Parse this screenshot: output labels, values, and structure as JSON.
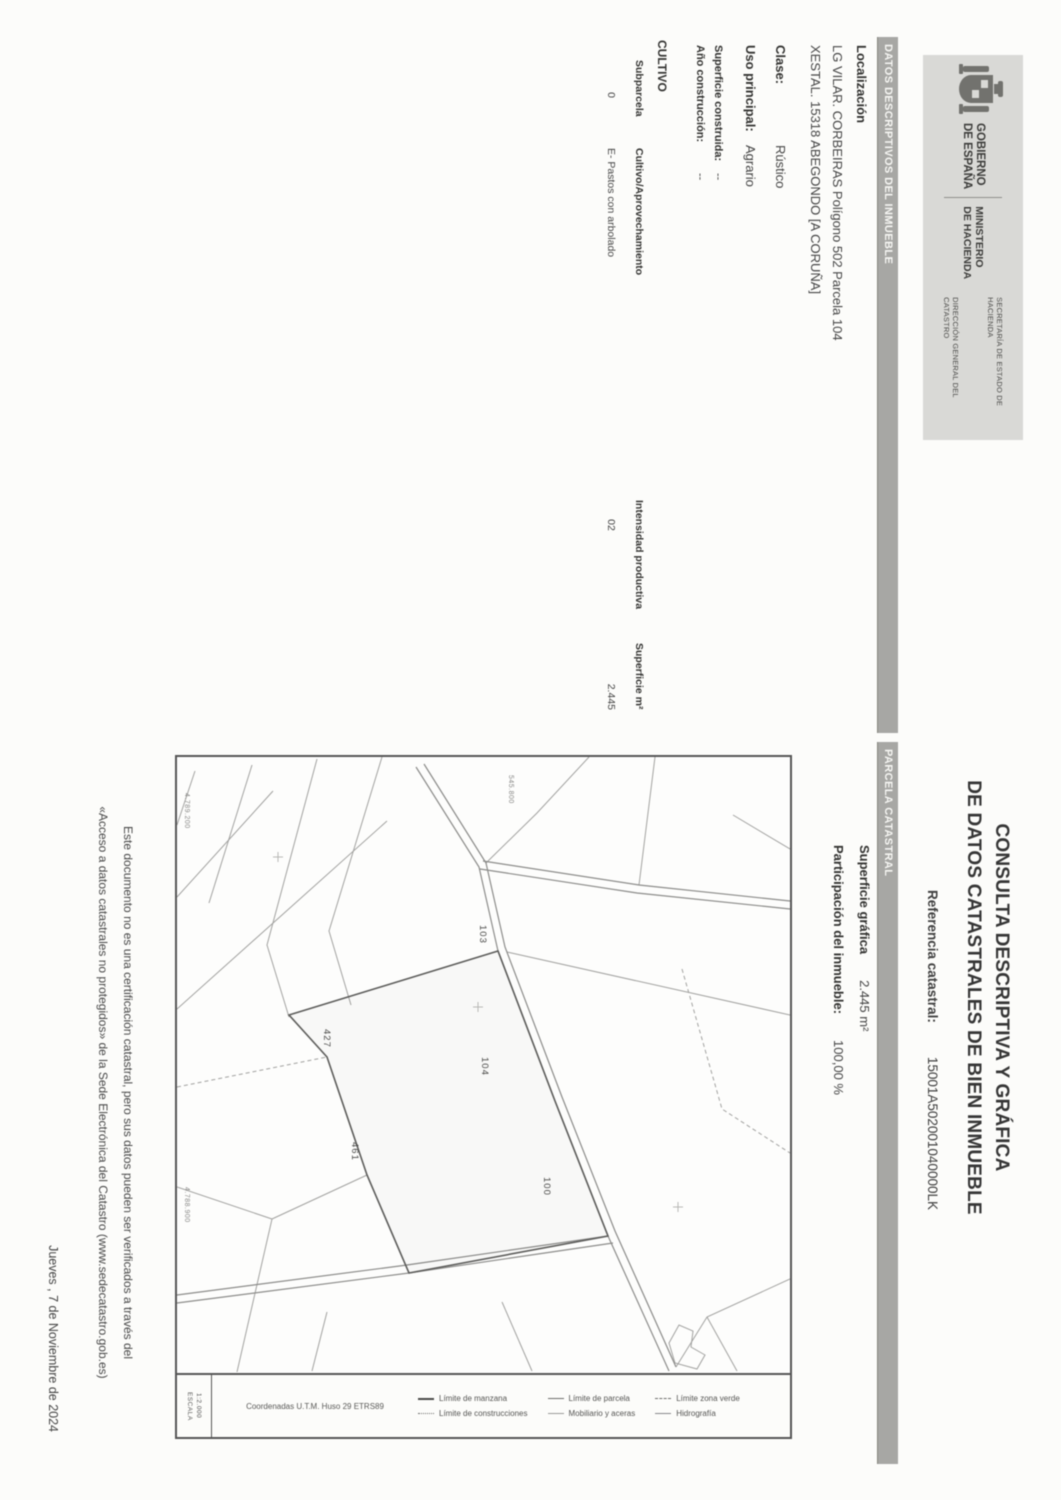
{
  "header": {
    "government": {
      "line1": "GOBIERNO",
      "line2": "DE ESPAÑA",
      "ministry1": "MINISTERIO",
      "ministry2": "DE HACIENDA",
      "secretaria": "SECRETARÍA DE ESTADO DE HACIENDA",
      "direccion": "DIRECCIÓN GENERAL DEL CATASTRO"
    },
    "title_line1": "CONSULTA DESCRIPTIVA Y GRÁFICA",
    "title_line2": "DE DATOS CATASTRALES DE BIEN INMUEBLE",
    "ref_label": "Referencia catastral:",
    "ref_value": "15001A502001040000LK"
  },
  "sections": {
    "inmueble_bar": "DATOS DESCRIPTIVOS DEL INMUEBLE",
    "parcela_bar": "PARCELA CATASTRAL"
  },
  "inmueble": {
    "localizacion_label": "Localización",
    "address_line1": "LG VILAR. CORBEIRAS Polígono 502 Parcela 104",
    "address_line2": "XESTAL. 15318 ABEGONDO [A CORUÑA]",
    "clase_label": "Clase:",
    "clase_value": "Rústico",
    "uso_label": "Uso principal:",
    "uso_value": "Agrario",
    "superficie_label": "Superficie construida:",
    "superficie_value": "--",
    "anio_label": "Año construcción:",
    "anio_value": "--"
  },
  "cultivo": {
    "title": "CULTIVO",
    "headers": [
      "Subparcela",
      "Cultivo/Aprovechamiento",
      "Intensidad productiva",
      "Superficie m²"
    ],
    "rows": [
      [
        "0",
        "E- Pastos con arbolado",
        "02",
        "2.445"
      ]
    ]
  },
  "parcela": {
    "superficie_label": "Superficie gráfica",
    "superficie_value": "2.445 m²",
    "participacion_label": "Participación del inmueble:",
    "participacion_value": "100,00 %"
  },
  "map": {
    "parcels": [
      "103",
      "427",
      "104",
      "461",
      "100"
    ],
    "coord_left_top": "4.789.200",
    "coord_top": "545.800",
    "coord_left_bottom": "4.788.900",
    "scale_label": "ESCALA",
    "scale": "1:2.000",
    "footer_coords": "Coordenadas U.T.M. Huso 29 ETRS89",
    "legend": [
      {
        "label": "Límite de manzana"
      },
      {
        "label": "Límite de parcela"
      },
      {
        "label": "Límite zona verde"
      },
      {
        "label": "Límite de construcciones"
      },
      {
        "label": "Mobiliario y aceras"
      },
      {
        "label": "Hidrografía"
      }
    ]
  },
  "footer": {
    "disclaimer_line1": "Este documento no es una certificación catastral, pero sus datos pueden ser verificados a través del",
    "disclaimer_line2": "«Acceso a datos catastrales no protegidos» de la Sede Electrónica del Catastro (www.sedecatastro.gob.es)",
    "date": "Jueves , 7 de Noviembre de 2024"
  }
}
